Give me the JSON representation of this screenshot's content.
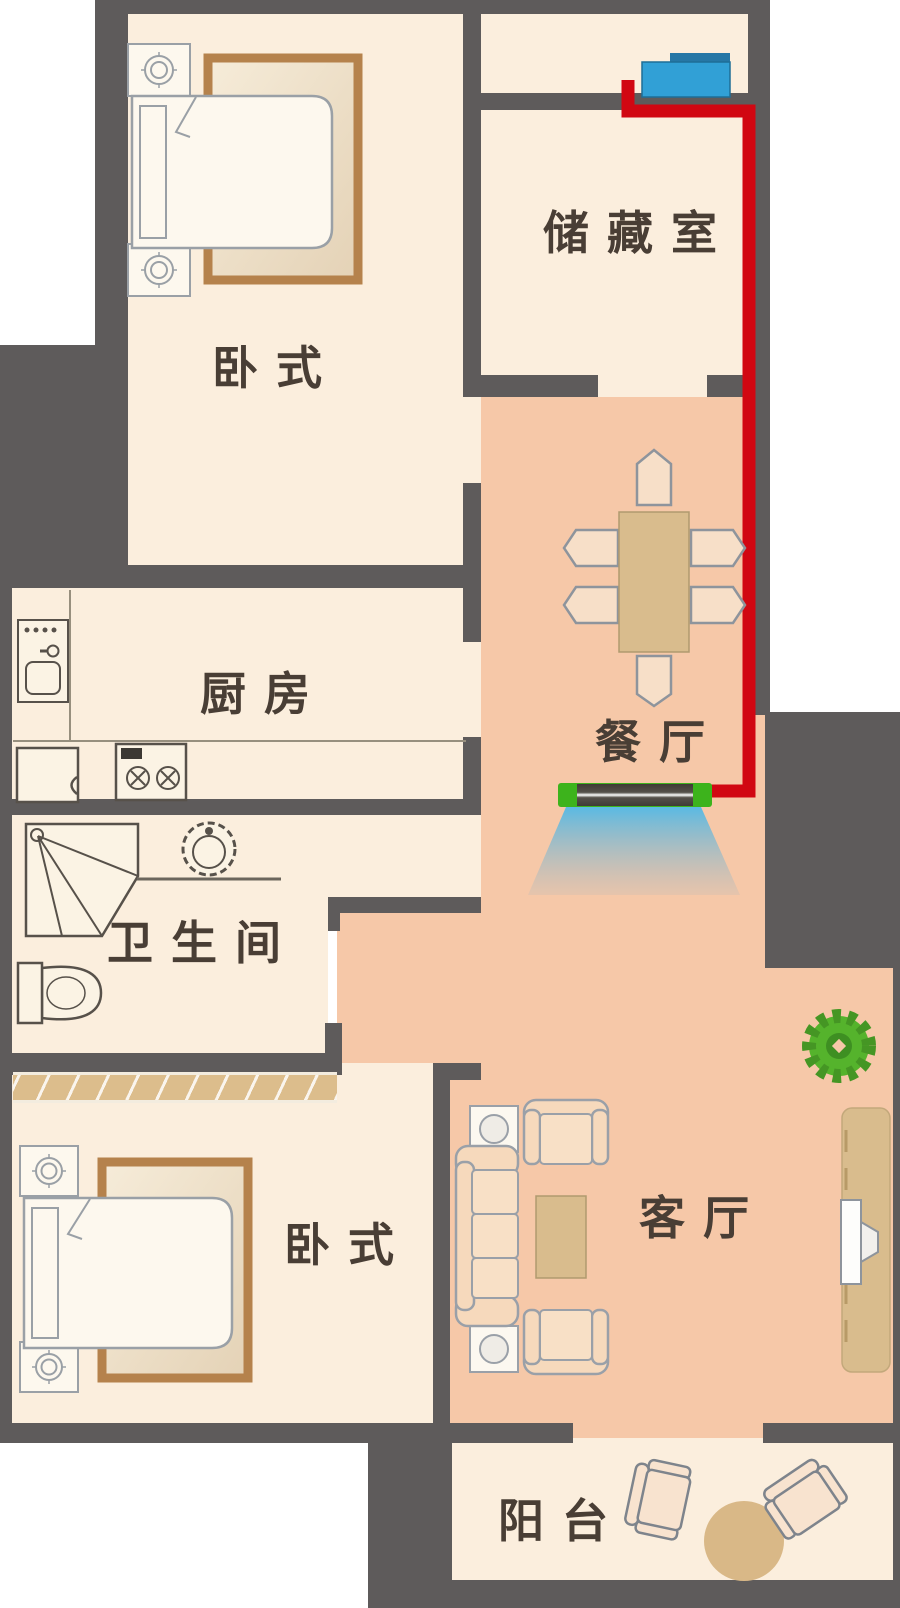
{
  "title": "apartment-floor-plan",
  "rooms": {
    "bedroom_top": {
      "label": "卧式"
    },
    "storage": {
      "label": "储藏室"
    },
    "kitchen": {
      "label": "厨房"
    },
    "dining": {
      "label": "餐厅"
    },
    "bathroom": {
      "label": "卫生间"
    },
    "bedroom_bottom": {
      "label": "卧式"
    },
    "living": {
      "label": "客厅"
    },
    "balcony": {
      "label": "阳台"
    }
  },
  "colors": {
    "wall": "#5e5b5b",
    "room": "#fbeedd",
    "hall": "#f6c8a8",
    "cable": "#d10712",
    "device": "#31a0d6",
    "device_top": "#2677a6",
    "curtain_green": "#3db31c",
    "airflow": "#52b9e6",
    "wood": "#d9bc8d",
    "rug": "#b5824c",
    "hatch": "#dcbd8c",
    "outline": "#8e949c",
    "fixture": "#57514a",
    "label": "#493e35"
  },
  "icons": [
    "double-bed-icon",
    "nightstand-lamp-icon",
    "rug-icon",
    "wardrobe-icon",
    "kitchen-sink-icon",
    "stove-icon",
    "refrigerator-icon",
    "shower-icon",
    "washbasin-icon",
    "toilet-icon",
    "dining-table-icon",
    "dining-chair-icon",
    "sofa-icon",
    "armchair-icon",
    "coffee-table-icon",
    "side-table-lamp-icon",
    "tv-icon",
    "tv-cabinet-icon",
    "potted-plant-icon",
    "balcony-chair-icon",
    "balcony-table-icon",
    "control-box-icon",
    "air-curtain-icon",
    "airflow-icon",
    "power-cable"
  ]
}
